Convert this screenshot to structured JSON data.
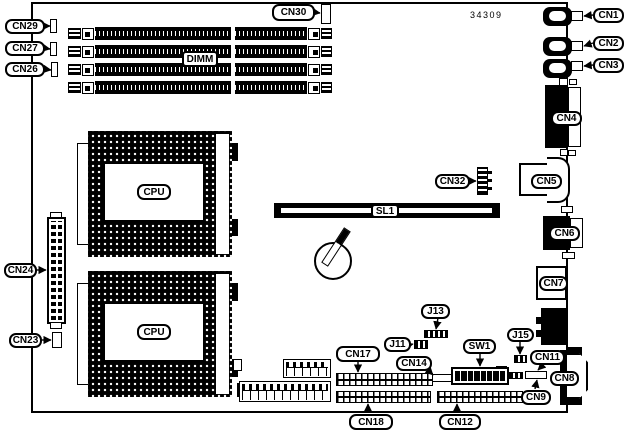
{
  "diagram": {
    "kind": "motherboard-connector-location-diagram",
    "part_number": "34309",
    "colors": {
      "ink": "#000000",
      "background": "#ffffff"
    },
    "labels": {
      "cn1": "CN1",
      "cn2": "CN2",
      "cn3": "CN3",
      "cn4": "CN4",
      "cn5": "CN5",
      "cn6": "CN6",
      "cn7": "CN7",
      "cn8": "CN8",
      "cn9": "CN9",
      "cn11": "CN11",
      "cn12": "CN12",
      "cn14": "CN14",
      "cn17": "CN17",
      "cn18": "CN18",
      "cn23": "CN23",
      "cn24": "CN24",
      "cn26": "CN26",
      "cn27": "CN27",
      "cn29": "CN29",
      "cn30": "CN30",
      "cn32": "CN32",
      "j11": "J11",
      "j13": "J13",
      "j15": "J15",
      "sw1": "SW1",
      "sl1": "SL1",
      "dimm": "DIMM",
      "cpu": "CPU"
    }
  }
}
